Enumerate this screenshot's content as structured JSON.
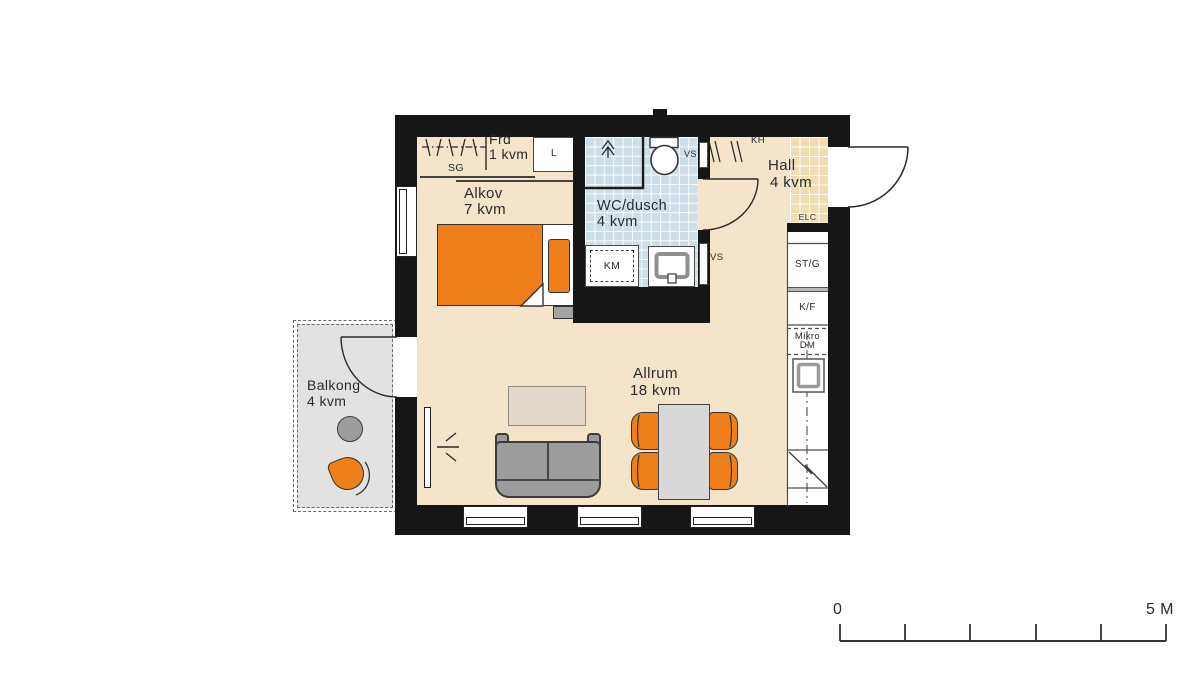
{
  "drawing_type": "apartment floor plan",
  "rooms": {
    "alkov": {
      "name": "Alkov",
      "area": "7 kvm"
    },
    "frd": {
      "name": "Frd",
      "area": "1 kvm"
    },
    "wc": {
      "name": "WC/dusch",
      "area": "4 kvm"
    },
    "hall": {
      "name": "Hall",
      "area": "4 kvm"
    },
    "allrum": {
      "name": "Allrum",
      "area": "18 kvm"
    },
    "balkong": {
      "name": "Balkong",
      "area": "4 kvm"
    }
  },
  "labels": {
    "sg": "SG",
    "l": "L",
    "km": "KM",
    "vs": "VS",
    "kh": "KH",
    "elc": "ELC",
    "stg": "ST/G",
    "kf": "K/F",
    "mikro": "Mikro",
    "dm": "DM"
  },
  "scalebar": {
    "start": "0",
    "end": "5 M"
  },
  "fixtures": [
    "bed",
    "pillow",
    "nightstand",
    "sofa",
    "coffee-table",
    "dining-table",
    "dining-chair",
    "balcony-table",
    "balcony-chair",
    "toilet",
    "washbasin",
    "washing-machine",
    "floor-drain",
    "shower-enclosure",
    "radiator",
    "coat-hooks",
    "wardrobe-rail",
    "kitchen-sink",
    "counter",
    "window",
    "door-swing"
  ],
  "colors": {
    "wall": "#161616",
    "floor": "#f3e4ca",
    "wc_tile": "#cddee8",
    "hall_tile": "#f2ddb2",
    "balcony": "#e2e2e2",
    "accent_orange": "#ef7f1a",
    "furniture_gray": "#9c9c9c",
    "line": "#2b2b2b"
  }
}
